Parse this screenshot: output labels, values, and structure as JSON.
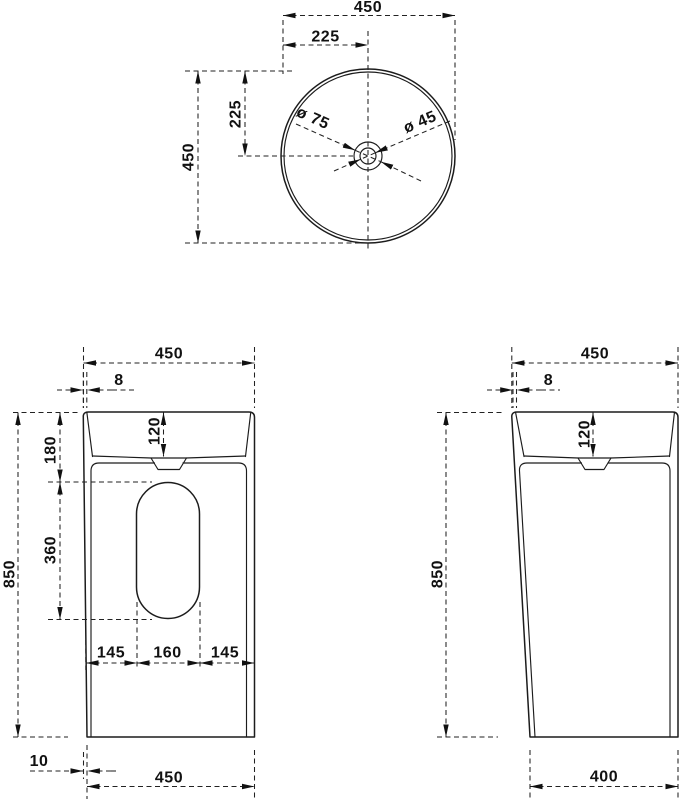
{
  "drawing": {
    "line_color": "#1c1c1c",
    "dim_color": "#222222",
    "background": "#ffffff",
    "top_view": {
      "width": "450",
      "width_half": "225",
      "depth": "450",
      "depth_half": "225",
      "drain_outer_diameter": "ø 75",
      "drain_inner_diameter": "ø 45"
    },
    "front_view": {
      "width_top": "450",
      "rim_thickness": "8",
      "basin_depth": "120",
      "rim_to_cutout": "180",
      "cutout_height": "360",
      "height": "850",
      "cutout_left": "145",
      "cutout_width": "160",
      "cutout_right": "145",
      "base_inset": "10",
      "width_bottom": "450"
    },
    "side_view": {
      "width_top": "450",
      "rim_thickness": "8",
      "basin_depth": "120",
      "height": "850",
      "depth_bottom": "400"
    }
  }
}
